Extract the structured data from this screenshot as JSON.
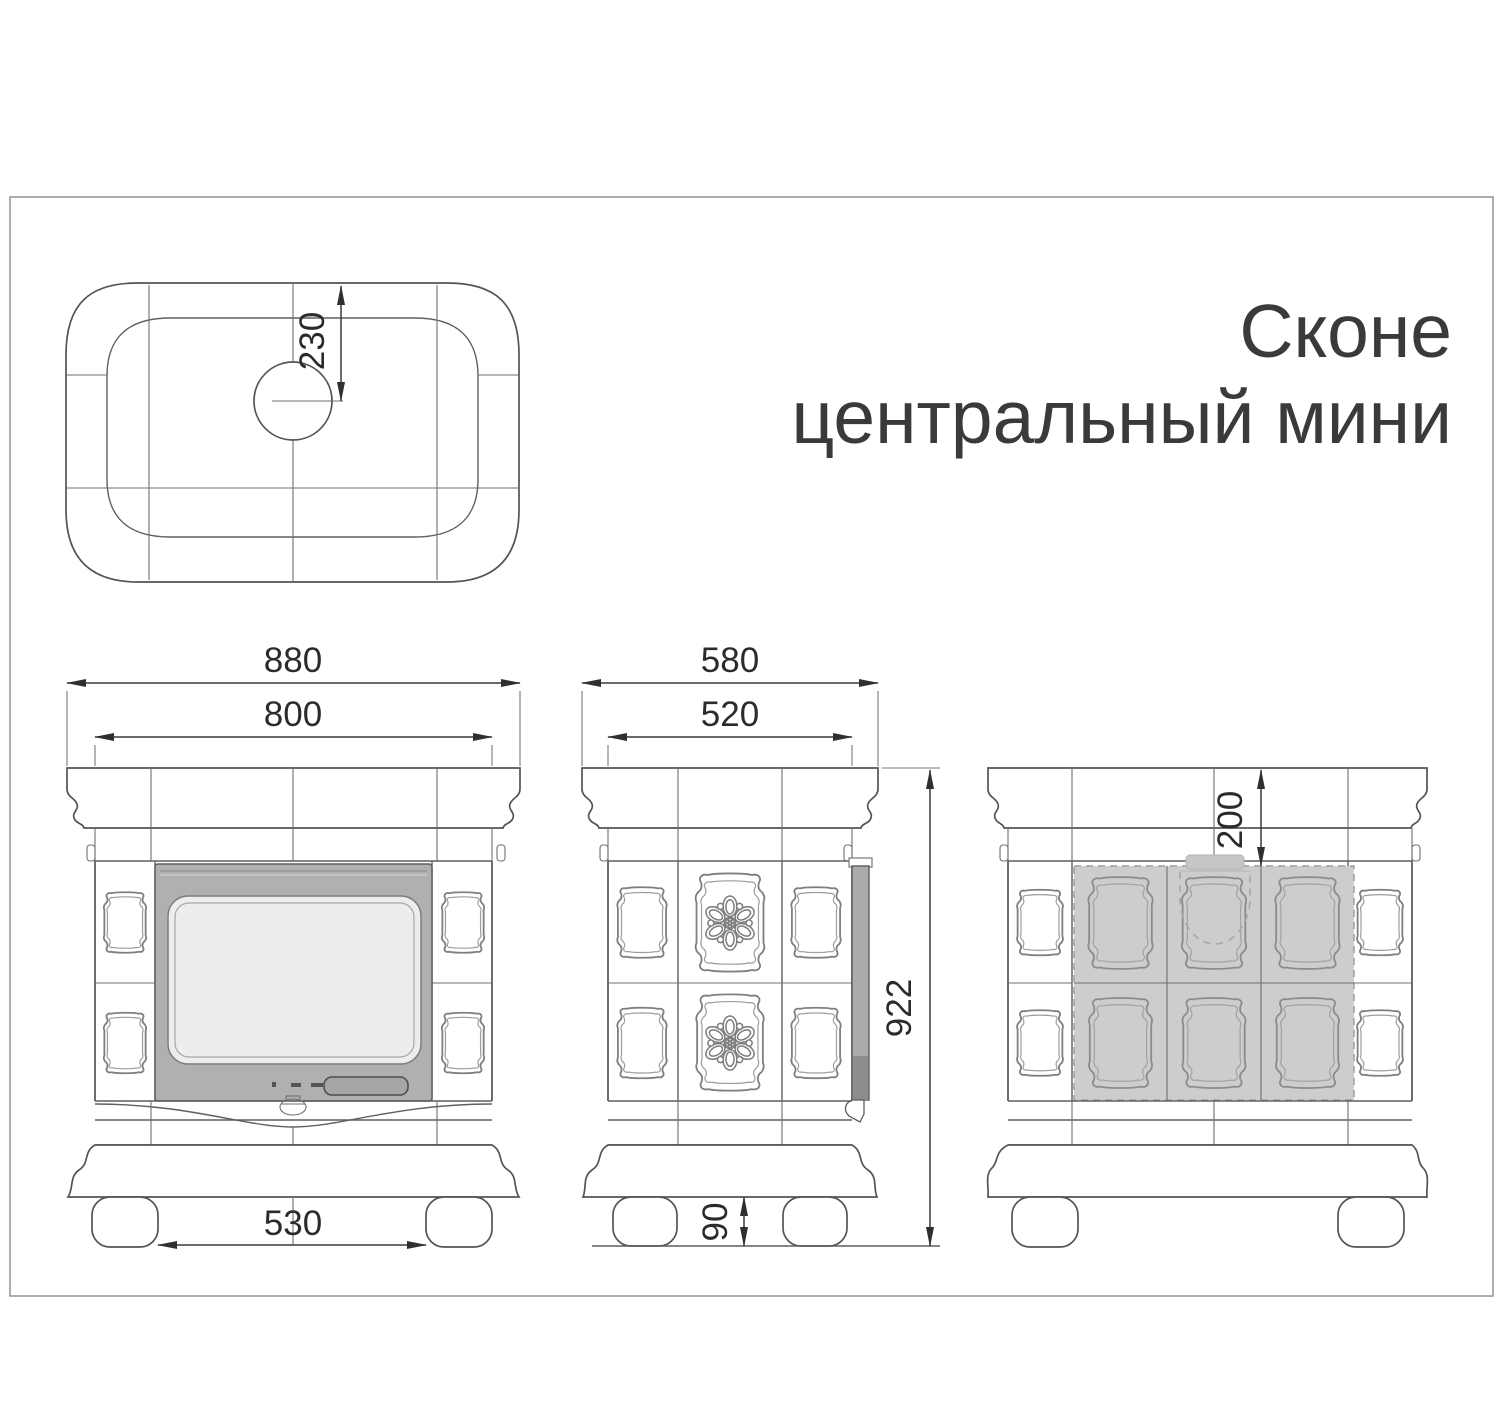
{
  "title": {
    "line1": "Сконе",
    "line2": "центральный мини"
  },
  "dimensions": {
    "top_view": {
      "flue_center_from_front_edge": "230"
    },
    "front_view": {
      "overall_width": "880",
      "body_width": "800",
      "feet_span": "530"
    },
    "side_view": {
      "overall_depth": "580",
      "body_depth": "520",
      "overall_height": "922",
      "feet_height": "90"
    },
    "rear_view": {
      "flue_offset_from_top": "200"
    }
  },
  "colors": {
    "line": "#545454",
    "dimension_text": "#2b2b2b",
    "door_fill": "#b0b0b0",
    "glass_fill": "#ededed",
    "handle_fill": "#a6a6a6",
    "door_edge_dark": "#8d8d8d",
    "shaded_rear_region": "#cdcdcd",
    "frame_border": "#9a9a9a"
  }
}
